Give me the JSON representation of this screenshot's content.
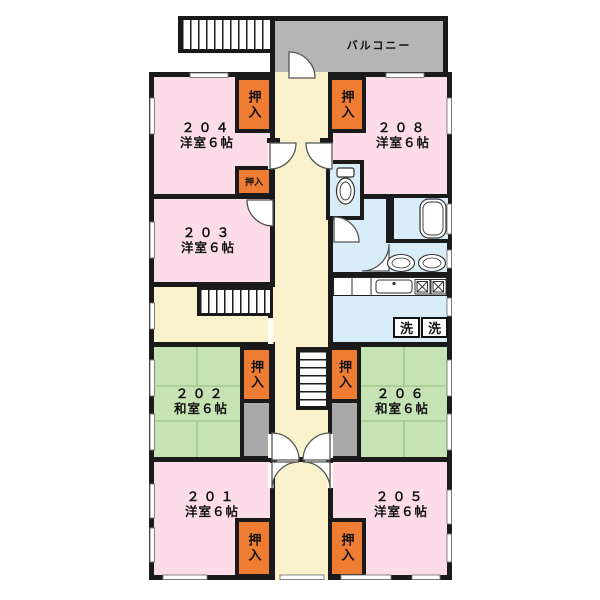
{
  "plan": {
    "balcony_label": "バルコニー",
    "laundry_label": "洗",
    "closet_label": "押入",
    "closet_label_small": "押入",
    "rooms": {
      "r204": {
        "number": "２０４",
        "type": "洋室６帖"
      },
      "r208": {
        "number": "２０８",
        "type": "洋室６帖"
      },
      "r203": {
        "number": "２０３",
        "type": "洋室６帖"
      },
      "r202": {
        "number": "２０２",
        "type": "和室６帖"
      },
      "r206": {
        "number": "２０６",
        "type": "和室６帖"
      },
      "r201": {
        "number": "２０１",
        "type": "洋室６帖"
      },
      "r205": {
        "number": "２０５",
        "type": "洋室６帖"
      }
    },
    "colors": {
      "western_room": "#fbdce8",
      "tatami_room": "#c6e3b4",
      "corridor": "#faf2cd",
      "closet": "#ef7c33",
      "utility": "#d8edf8",
      "balcony": "#b5b5b5",
      "vestibule": "#a9a9a9",
      "wall": "#1a1a1a"
    }
  }
}
